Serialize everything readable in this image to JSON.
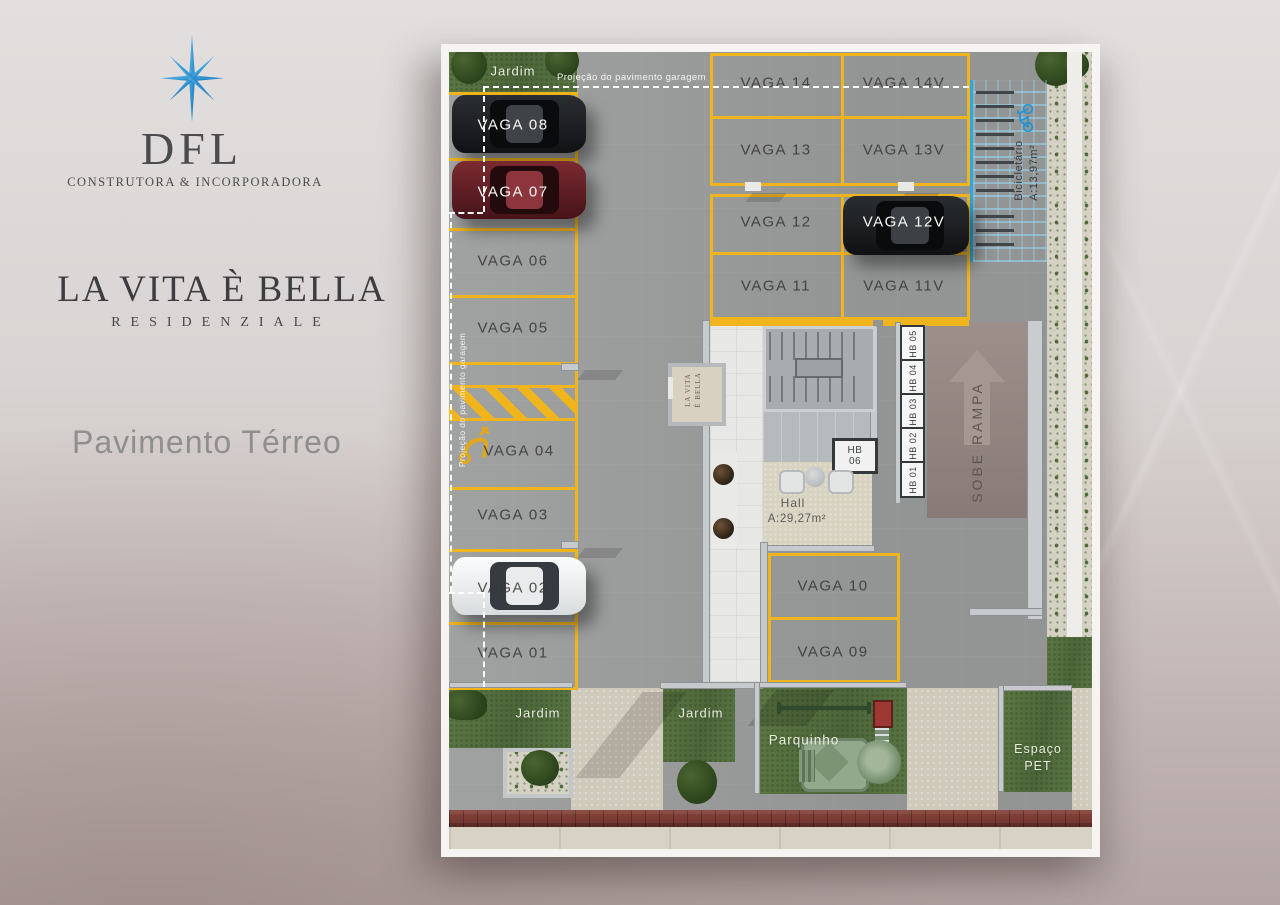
{
  "branding": {
    "monogram": "DFL",
    "subtitle": "CONSTRUTORA & INCORPORADORA",
    "project": "LA VITA È BELLA",
    "project_sub": "RESIDENZIALE",
    "floor": "Pavimento Térreo"
  },
  "colors": {
    "logo_blue": "#2a8fd3",
    "parking_yellow": "#f0b41c",
    "bike_blue": "#2ea6de",
    "brick_red": "#7c3b33",
    "grass_green": "#57713f",
    "ramp_mauve": "#8e807b"
  },
  "plan": {
    "projection_top": "Projeção do pavimento garagem",
    "projection_side": "Projeção do pavimento garagem",
    "left_column": [
      "VAGA 08",
      "VAGA 07",
      "VAGA 06",
      "VAGA 05",
      "VAGA 04",
      "VAGA 03",
      "VAGA 02",
      "VAGA 01"
    ],
    "center_grid": [
      "VAGA 14",
      "VAGA 14V",
      "VAGA 13",
      "VAGA 13V",
      "VAGA 12",
      "VAGA 12V",
      "VAGA 11",
      "VAGA 11V"
    ],
    "lower_pair": [
      "VAGA 10",
      "VAGA 09"
    ],
    "bike": {
      "name": "Bicicletário",
      "area": "A:13,97m²"
    },
    "ramp": "SOBE RAMPA",
    "hall": {
      "name": "Hall",
      "area": "A:29,27m²"
    },
    "hb_stack": [
      "HB 05",
      "HB 04",
      "HB 03",
      "HB 02",
      "HB 01"
    ],
    "hb06": {
      "line1": "HB",
      "line2": "06"
    },
    "totem": {
      "line1": "LA VITA",
      "line2": "È BELLA"
    },
    "garden_top": "Jardim",
    "garden_left": "Jardim",
    "garden_mid": "Jardim",
    "playground": "Parquinho",
    "pet": {
      "line1": "Espaço",
      "line2": "PET"
    }
  }
}
